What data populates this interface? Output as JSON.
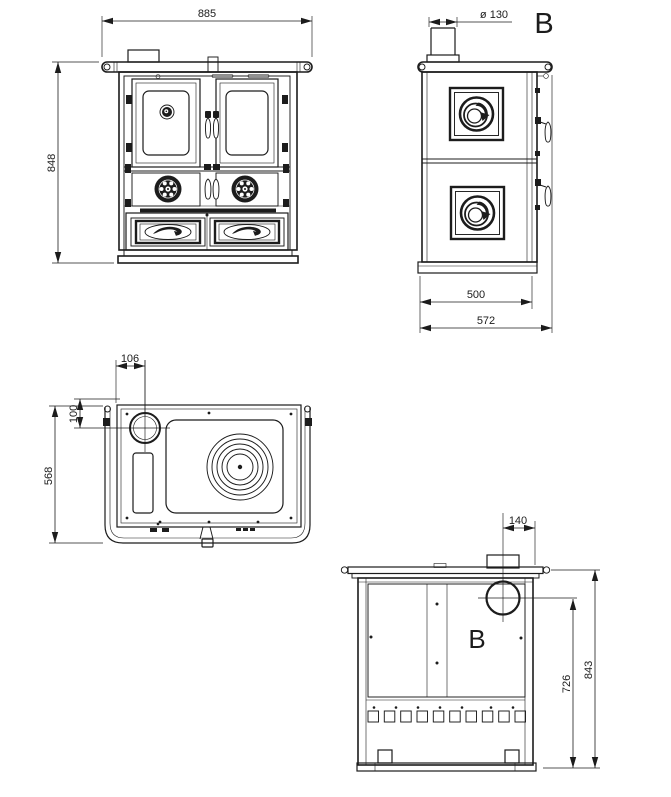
{
  "drawing": {
    "colors": {
      "line": "#1c1c1c",
      "background": "#ffffff"
    },
    "views": {
      "front": {
        "width": "885",
        "height": "848"
      },
      "side": {
        "flue_diameter": "ø 130",
        "section_label": "B",
        "body_depth": "500",
        "total_depth": "572"
      },
      "top": {
        "flue_offset_x": "106",
        "flue_offset_y": "100",
        "depth": "568"
      },
      "rear": {
        "flue_offset_from_right": "140",
        "flue_center_height": "726",
        "total_height": "843",
        "section_label": "B"
      }
    }
  }
}
